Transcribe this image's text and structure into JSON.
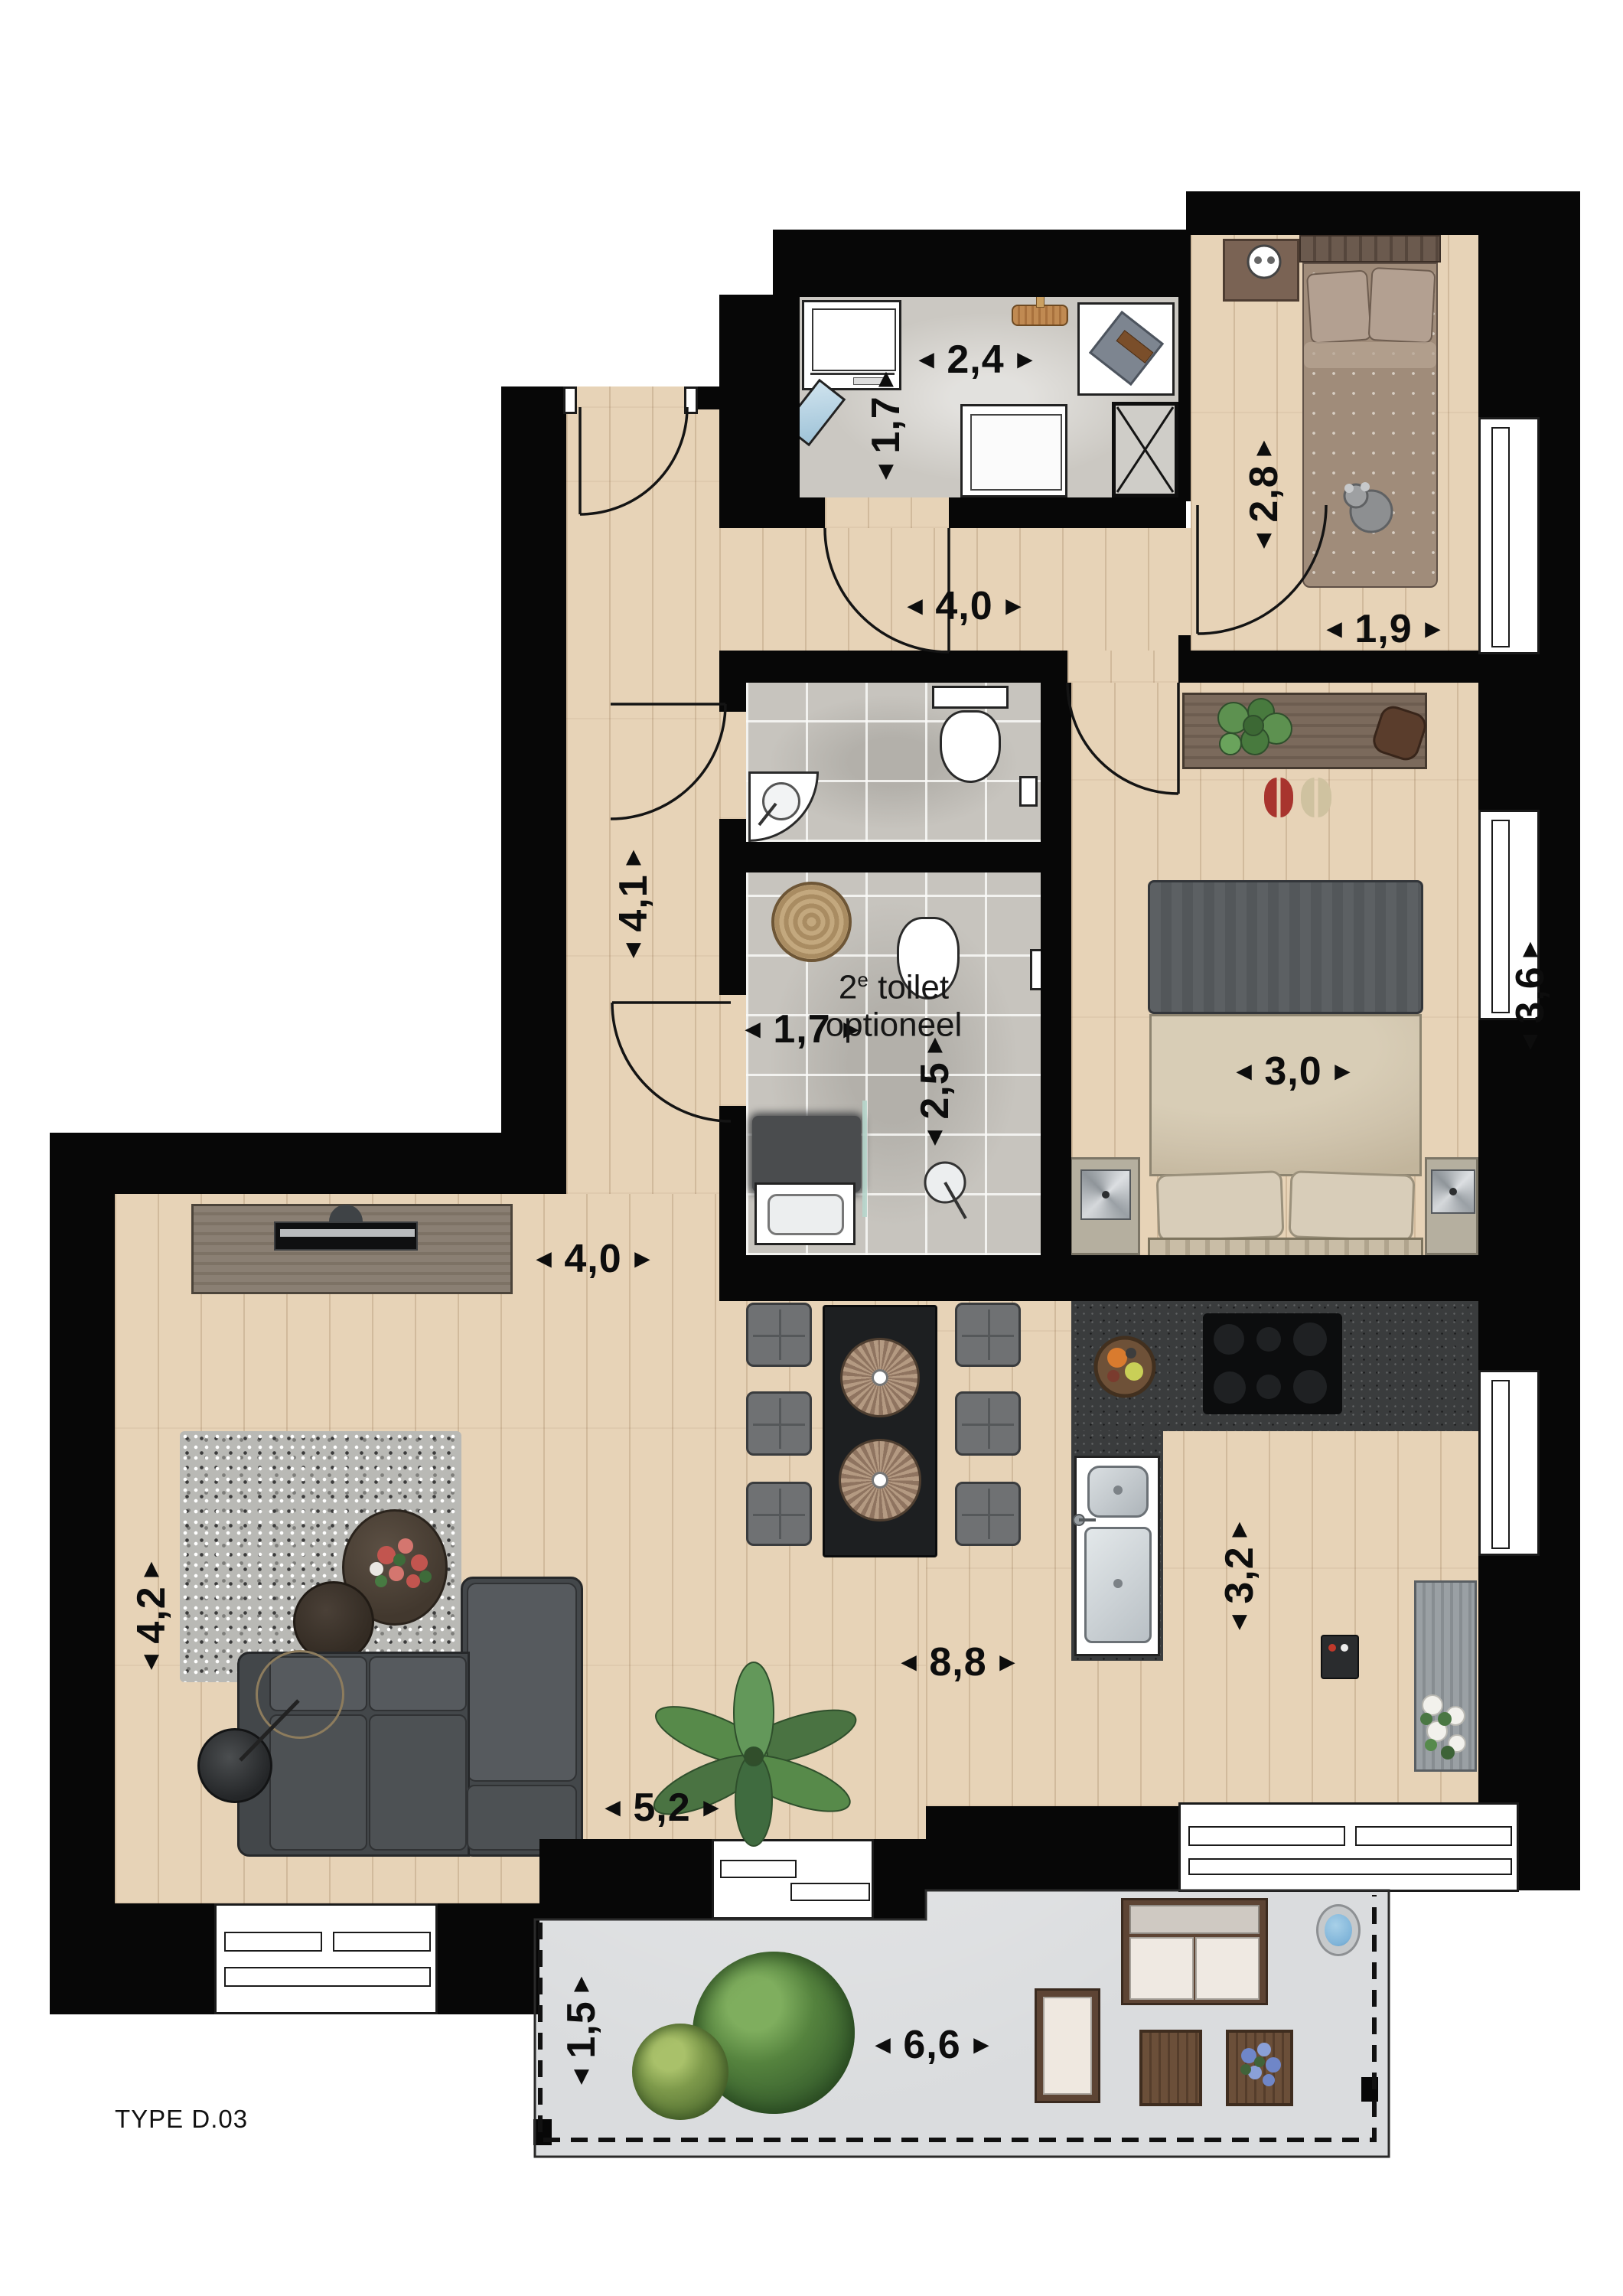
{
  "plan": {
    "type_label": "TYPE D.03",
    "kind": "apartment floor plan, top-down view"
  },
  "icons": {
    "arrow_left": "◄",
    "arrow_right": "►",
    "arrow_up": "▲",
    "arrow_down": "▼"
  },
  "dims": {
    "utility_width": {
      "text": "2,4"
    },
    "utility_depth": {
      "text": "1,7"
    },
    "hall_width": {
      "text": "4,0"
    },
    "bedroom2_depth": {
      "text": "2,8"
    },
    "bedroom2_width": {
      "text": "1,9"
    },
    "hall_depth": {
      "text": "4,1"
    },
    "bathroom_width": {
      "text": "1,7"
    },
    "bathroom_depth": {
      "text": "2,5"
    },
    "bedroom1_width": {
      "text": "3,0"
    },
    "bedroom1_depth": {
      "text": "3,6"
    },
    "living_top_width": {
      "text": "4,0"
    },
    "living_depth": {
      "text": "4,2"
    },
    "living_kitchen_width": {
      "text": "8,8"
    },
    "kitchen_depth": {
      "text": "3,2"
    },
    "living_bottom_width": {
      "text": "5,2"
    },
    "balcony_width": {
      "text": "6,6"
    },
    "balcony_depth": {
      "text": "1,5"
    }
  },
  "annotations": {
    "optional_toilet": {
      "line1_num": "2",
      "line1_sup": "e",
      "line1_rest": " toilet",
      "line2": "optioneel"
    }
  },
  "colors": {
    "wall": "#070707",
    "wood_floor": "#e7d3b7",
    "tile_floor": "#c7c4be",
    "balcony_floor": "#dadcde",
    "kitchen_counter": "#3a3c3d",
    "sofa": "#4a4e51",
    "accent_red_shoes": "#a8342e",
    "water_blue": "#7fb4d9"
  }
}
